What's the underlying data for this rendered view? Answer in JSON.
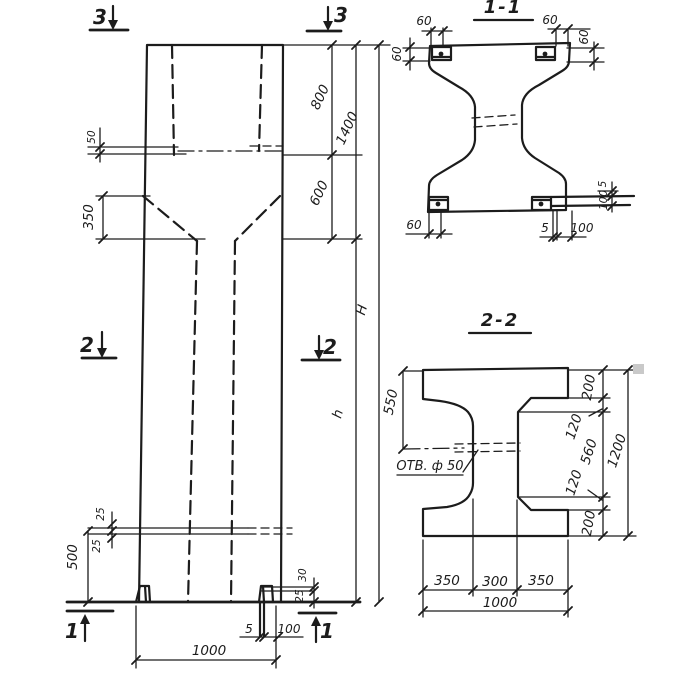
{
  "colors": {
    "ink": "#1c1c1c",
    "paper": "#ffffff",
    "artifact": "#c9c9c9"
  },
  "elevation": {
    "marker_top_left": "3",
    "marker_top_right": "3",
    "marker_mid_left": "2",
    "marker_mid_right": "2",
    "marker_bottom_left": "1",
    "marker_bottom_right": "1",
    "dim_plate_50": "50",
    "dim_taper_350": "350",
    "dim_top_800": "800",
    "dim_top_overall_1400": "1400",
    "dim_taper_600": "600",
    "dim_total_H": "H",
    "dim_shaft_h": "h",
    "dim_bar_25_top": "25",
    "dim_bar_25_bottom": "25",
    "dim_bottom_500": "500",
    "dim_foot_30": "30",
    "dim_foot_25": "25",
    "dim_foot_plate_5": "5",
    "dim_foot_plate_100": "100",
    "dim_width_1000": "1000"
  },
  "section_1_1": {
    "title": "1-1",
    "dim_60_top_left_h": "60",
    "dim_60_top_left_v": "60",
    "dim_60_top_right_h": "60",
    "dim_60_top_right_v": "60",
    "dim_60_bottom_left": "60",
    "dim_5_bottom_right": "5",
    "dim_100_bottom_right": "100",
    "dim_5_right_edge": "5",
    "dim_100_right_edge": "100"
  },
  "section_2_2": {
    "title": "2-2",
    "hole_label": "ОТВ. ф 50",
    "dim_550": "550",
    "dim_200_top": "200",
    "dim_120_top": "120",
    "dim_560": "560",
    "dim_120_bottom": "120",
    "dim_200_bottom": "200",
    "dim_1200": "1200",
    "dim_350_left": "350",
    "dim_300": "300",
    "dim_350_right": "350",
    "dim_1000": "1000"
  }
}
